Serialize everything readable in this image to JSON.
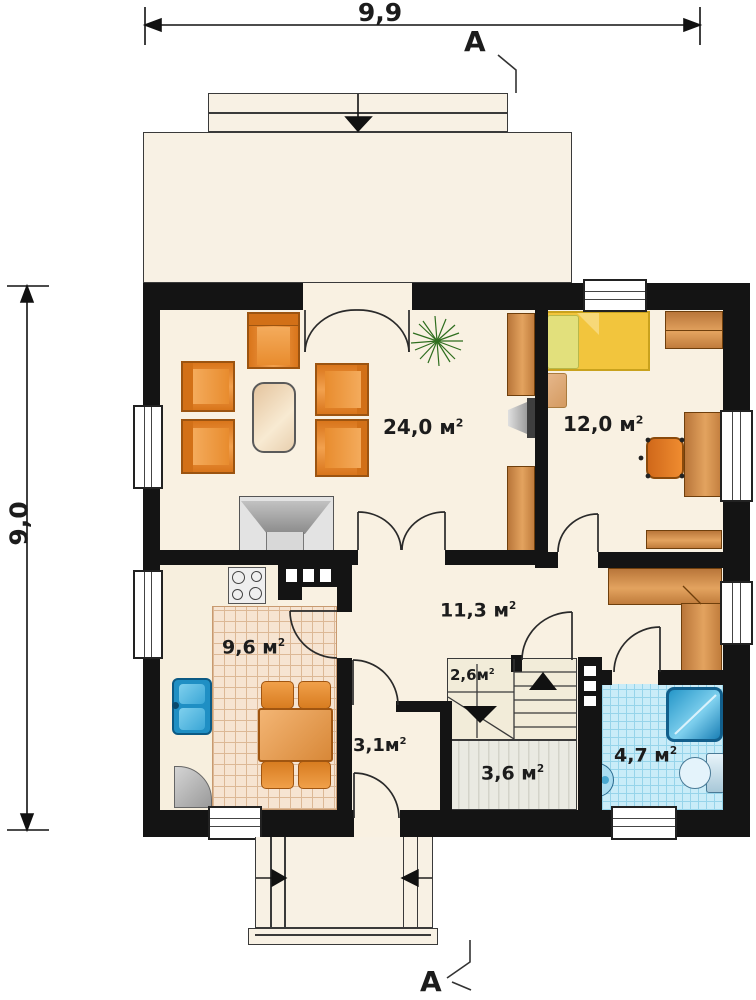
{
  "dimensions": {
    "width": "9,9",
    "height": "9,0"
  },
  "section_marker": "A",
  "unit": {
    "symbol": "м",
    "exponent": "2"
  },
  "rooms": {
    "living": "24,0",
    "bedroom": "12,0",
    "hall": "11,3",
    "kitchen": "9,6",
    "pantry": "2,6",
    "corridor": "3,1",
    "vestibule": "3,6",
    "bathroom": "4,7"
  },
  "colors": {
    "wall": "#141414",
    "floor": "#f9f1e2",
    "furniture_orange": "#e8872a",
    "wood": "#c98540",
    "bed_yellow": "#f2c53d",
    "bath_tile": "#c9ecf8",
    "fixture_blue": "#28a0d8",
    "kitchen_tile": "#f6e4d2"
  }
}
